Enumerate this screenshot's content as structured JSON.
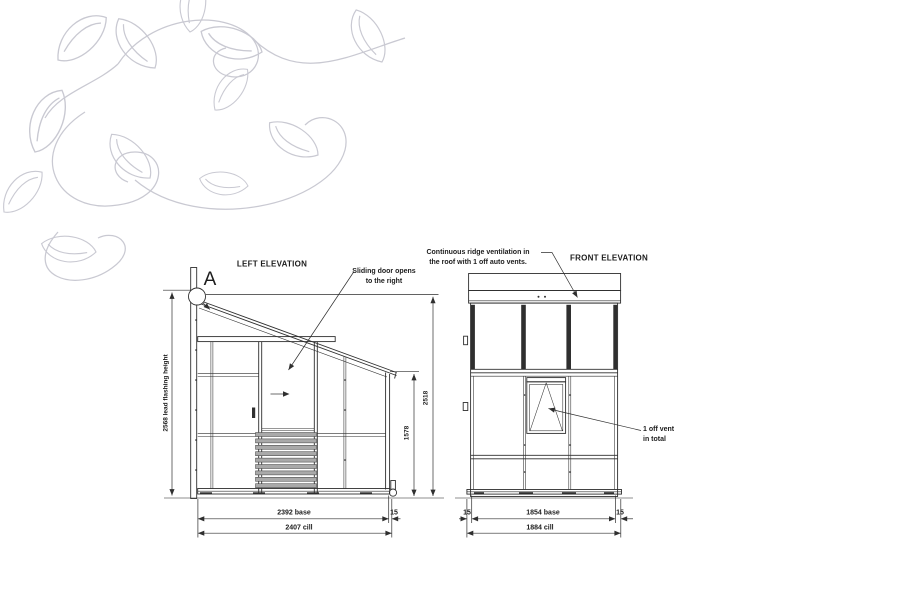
{
  "drawing": {
    "left_elevation": {
      "title": "LEFT ELEVATION",
      "detail_marker": "A",
      "door_note_line1": "Sliding door opens",
      "door_note_line2": "to the right",
      "dim_flashing_height": "2568 lead flashing height",
      "dim_ridge_height": "2518",
      "dim_eaves_height": "1578",
      "dim_base": "2392 base",
      "dim_cill_offset": "15",
      "dim_cill": "2407 cill"
    },
    "front_elevation": {
      "title": "FRONT ELEVATION",
      "ridge_note_line1": "Continuous ridge ventilation in",
      "ridge_note_line2": "the roof with 1 off auto vents.",
      "vent_note_line1": "1 off vent",
      "vent_note_line2": "in total",
      "dim_left_offset": "15",
      "dim_base": "1854 base",
      "dim_right_offset": "15",
      "dim_cill": "1884 cill"
    },
    "colors": {
      "line": "#2f2f2f",
      "leaf": "#c9c9d2",
      "ground": "#8f8f8f"
    }
  }
}
